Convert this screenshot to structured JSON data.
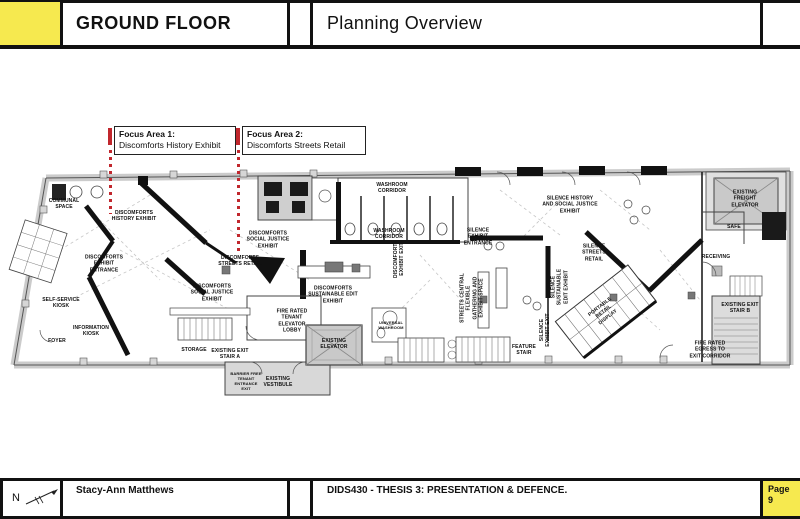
{
  "header": {
    "title": "GROUND FLOOR",
    "subtitle": "Planning Overview"
  },
  "focus_areas": [
    {
      "title": "Focus Area 1:",
      "subtitle": "Discomforts History Exhibit"
    },
    {
      "title": "Focus Area 2:",
      "subtitle": "Discomforts Streets Retail"
    }
  ],
  "plan": {
    "rooms": [
      {
        "label": "Communal Space"
      },
      {
        "label": "Discomforts History Exhibit"
      },
      {
        "label": "Discomforts Exhibit Entrance"
      },
      {
        "label": "Discomforts Social Justice Exhibit"
      },
      {
        "label": "Discomforts Streets Retail"
      },
      {
        "label": "Discomforts Social Justice Exhibit"
      },
      {
        "label": "Self-Service Kiosk"
      },
      {
        "label": "Information Kiosk"
      },
      {
        "label": "Foyer"
      },
      {
        "label": "Storage"
      },
      {
        "label": "Existing Exit Stair A"
      },
      {
        "label": "Fire Rated Tenant Elevator Lobby"
      },
      {
        "label": "Existing Vestibule"
      },
      {
        "label": "Barrier Free Tenant Entrance Exit"
      },
      {
        "label": "Existing Elevator"
      },
      {
        "label": "Discomforts Sustainable Edit Exhibit"
      },
      {
        "label": "Washroom Corridor"
      },
      {
        "label": "Washroom Corridor"
      },
      {
        "label": "Discomforts Exhibit Exit"
      },
      {
        "label": "Silence Exhibit Entrance"
      },
      {
        "label": "Silence History and Social Justice Exhibit"
      },
      {
        "label": "Silence Streets Retail"
      },
      {
        "label": "Streets Central Flexible Gathering and Exhibit Space"
      },
      {
        "label": "Silence Sustainable Edit Exhibit"
      },
      {
        "label": "Silence Exhibit Exit"
      },
      {
        "label": "Feature Stair"
      },
      {
        "label": "Portable Retail Display"
      },
      {
        "label": "Existing Freight Elevator"
      },
      {
        "label": "Safe"
      },
      {
        "label": "Receiving"
      },
      {
        "label": "Existing Exit Stair B"
      },
      {
        "label": "Fire Rated Egress to Exit Corridor"
      },
      {
        "label": "Universal Washroom"
      }
    ]
  },
  "footer": {
    "north": "N",
    "author": "Stacy-Ann Matthews",
    "course": "DIDS430 - THESIS 3: PRESENTATION & DEFENCE.",
    "page_word": "Page",
    "page_number": "9"
  },
  "colors": {
    "yellow": "#F6E94F",
    "red": "#C1272D"
  }
}
